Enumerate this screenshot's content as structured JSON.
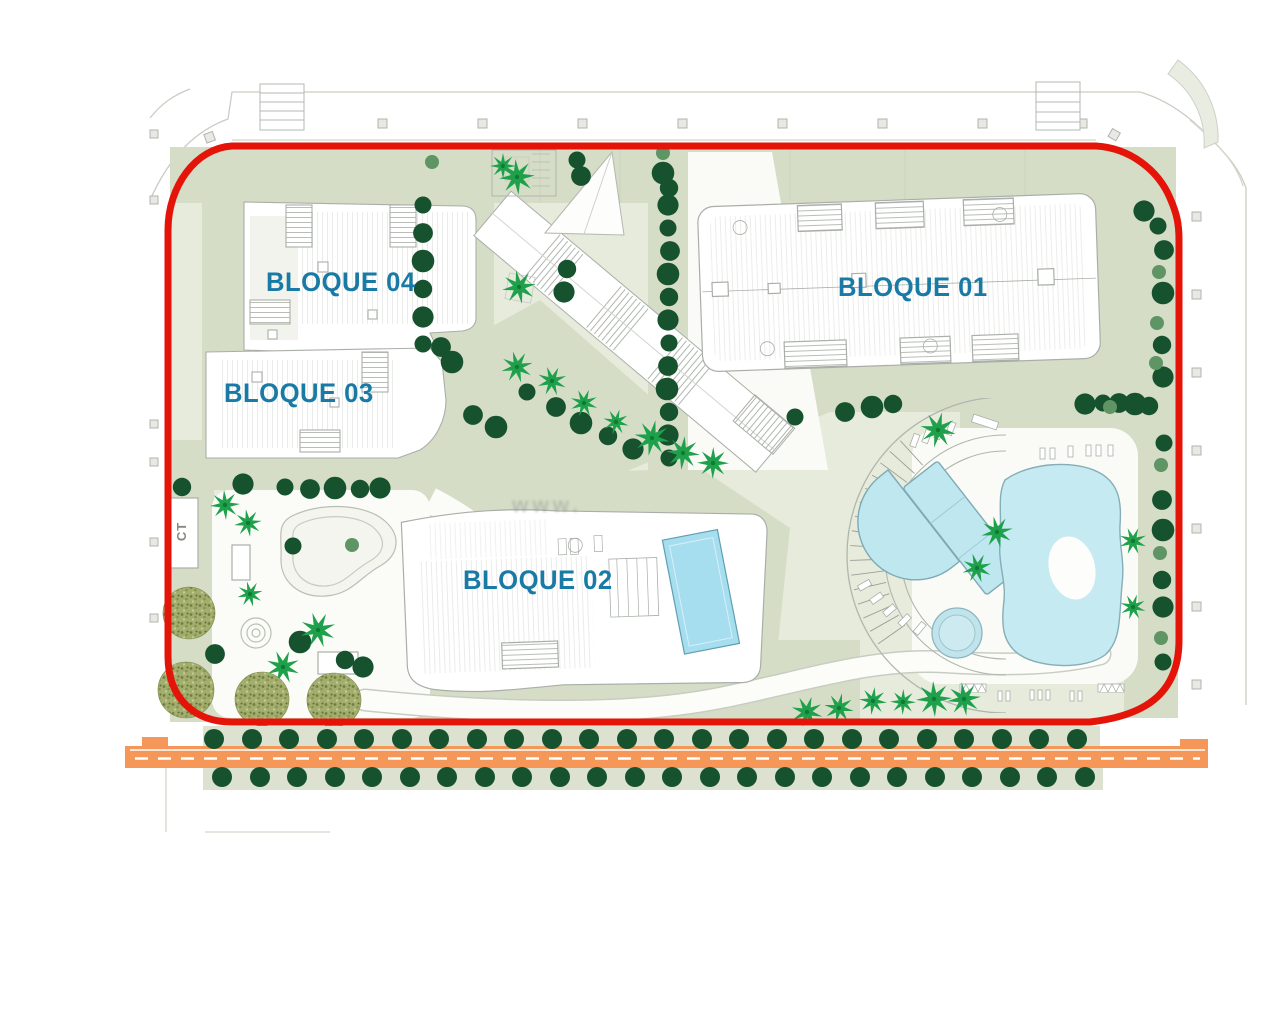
{
  "title": "Residential site plan",
  "labels": {
    "bloque01": "BLOQUE 01",
    "bloque02": "BLOQUE 02",
    "bloque03": "BLOQUE 03",
    "bloque04": "BLOQUE 04",
    "ct": "CT",
    "watermark": "www."
  },
  "colors": {
    "boundary_red": "#e41408",
    "road_orange": "#f6975a",
    "ground_light": "#e7ebdc",
    "ground_olive": "#d6ddc6",
    "strip_green": "#dce2cf",
    "pool_blue": "#c6eaf2",
    "rooftop_pool_blue": "#a6def0",
    "tree_dark_green": "#16522e",
    "tree_light_green": "#5f9464",
    "palm_green": "#1fa14c",
    "olive_tree_green": "#a3ad6e",
    "label_blue": "#187aa5",
    "outline_grey": "#a9afa8"
  },
  "plan": {
    "dark_trees": [
      [
        423,
        205
      ],
      [
        423,
        233
      ],
      [
        423,
        261
      ],
      [
        423,
        289
      ],
      [
        423,
        317
      ],
      [
        423,
        344
      ],
      [
        441,
        347
      ],
      [
        452,
        362
      ],
      [
        567,
        269
      ],
      [
        564,
        292
      ],
      [
        577,
        160
      ],
      [
        581,
        176
      ],
      [
        663,
        173
      ],
      [
        669,
        188
      ],
      [
        668,
        205
      ],
      [
        668,
        228
      ],
      [
        670,
        251
      ],
      [
        668,
        274
      ],
      [
        669,
        297
      ],
      [
        668,
        320
      ],
      [
        669,
        343
      ],
      [
        668,
        366
      ],
      [
        667,
        389
      ],
      [
        669,
        412
      ],
      [
        668,
        435
      ],
      [
        669,
        458
      ],
      [
        473,
        415
      ],
      [
        496,
        427
      ],
      [
        182,
        487
      ],
      [
        243,
        484
      ],
      [
        285,
        487
      ],
      [
        310,
        489
      ],
      [
        335,
        488
      ],
      [
        360,
        489
      ],
      [
        380,
        488
      ],
      [
        527,
        392
      ],
      [
        556,
        407
      ],
      [
        581,
        423
      ],
      [
        608,
        436
      ],
      [
        633,
        449
      ],
      [
        795,
        417
      ],
      [
        845,
        412
      ],
      [
        872,
        407
      ],
      [
        893,
        404
      ],
      [
        1085,
        404
      ],
      [
        1103,
        403
      ],
      [
        1119,
        403
      ],
      [
        1135,
        404
      ],
      [
        1149,
        406
      ],
      [
        1144,
        211
      ],
      [
        1158,
        226
      ],
      [
        1164,
        250
      ],
      [
        1163,
        293
      ],
      [
        1162,
        345
      ],
      [
        1163,
        377
      ],
      [
        1164,
        443
      ],
      [
        1162,
        500
      ],
      [
        1163,
        530
      ],
      [
        1162,
        580
      ],
      [
        1163,
        607
      ],
      [
        1163,
        662
      ],
      [
        215,
        654
      ],
      [
        300,
        642
      ],
      [
        345,
        660
      ],
      [
        363,
        667
      ],
      [
        293,
        546
      ]
    ],
    "light_trees": [
      [
        663,
        153
      ],
      [
        1159,
        272
      ],
      [
        1157,
        323
      ],
      [
        1156,
        363
      ],
      [
        1161,
        465
      ],
      [
        1160,
        553
      ],
      [
        1161,
        638
      ],
      [
        1110,
        407
      ],
      [
        432,
        162
      ],
      [
        352,
        545
      ]
    ],
    "row_trees_top": {
      "y": 739,
      "xs": [
        214,
        252,
        289,
        327,
        364,
        402,
        439,
        477,
        514,
        552,
        589,
        627,
        664,
        702,
        739,
        777,
        814,
        852,
        889,
        927,
        964,
        1002,
        1039,
        1077
      ]
    },
    "row_trees_bottom": {
      "y": 777,
      "xs": [
        222,
        260,
        297,
        335,
        372,
        410,
        447,
        485,
        522,
        560,
        597,
        635,
        672,
        710,
        747,
        785,
        822,
        860,
        897,
        935,
        972,
        1010,
        1047,
        1085
      ]
    },
    "palms": [
      [
        503,
        166
      ],
      [
        517,
        177
      ],
      [
        519,
        287
      ],
      [
        517,
        367
      ],
      [
        552,
        381
      ],
      [
        584,
        403
      ],
      [
        616,
        422
      ],
      [
        652,
        438
      ],
      [
        683,
        453
      ],
      [
        713,
        463
      ],
      [
        225,
        505
      ],
      [
        248,
        523
      ],
      [
        250,
        594
      ],
      [
        318,
        630
      ],
      [
        283,
        667
      ],
      [
        807,
        712
      ],
      [
        839,
        708
      ],
      [
        873,
        701
      ],
      [
        903,
        702
      ],
      [
        934,
        699
      ],
      [
        964,
        699
      ],
      [
        997,
        532
      ],
      [
        977,
        568
      ],
      [
        1133,
        541
      ],
      [
        1133,
        607
      ],
      [
        938,
        430
      ]
    ],
    "olive_trees": [
      [
        189,
        613,
        26
      ],
      [
        186,
        690,
        28
      ],
      [
        262,
        699,
        27
      ],
      [
        334,
        700,
        27
      ]
    ]
  }
}
